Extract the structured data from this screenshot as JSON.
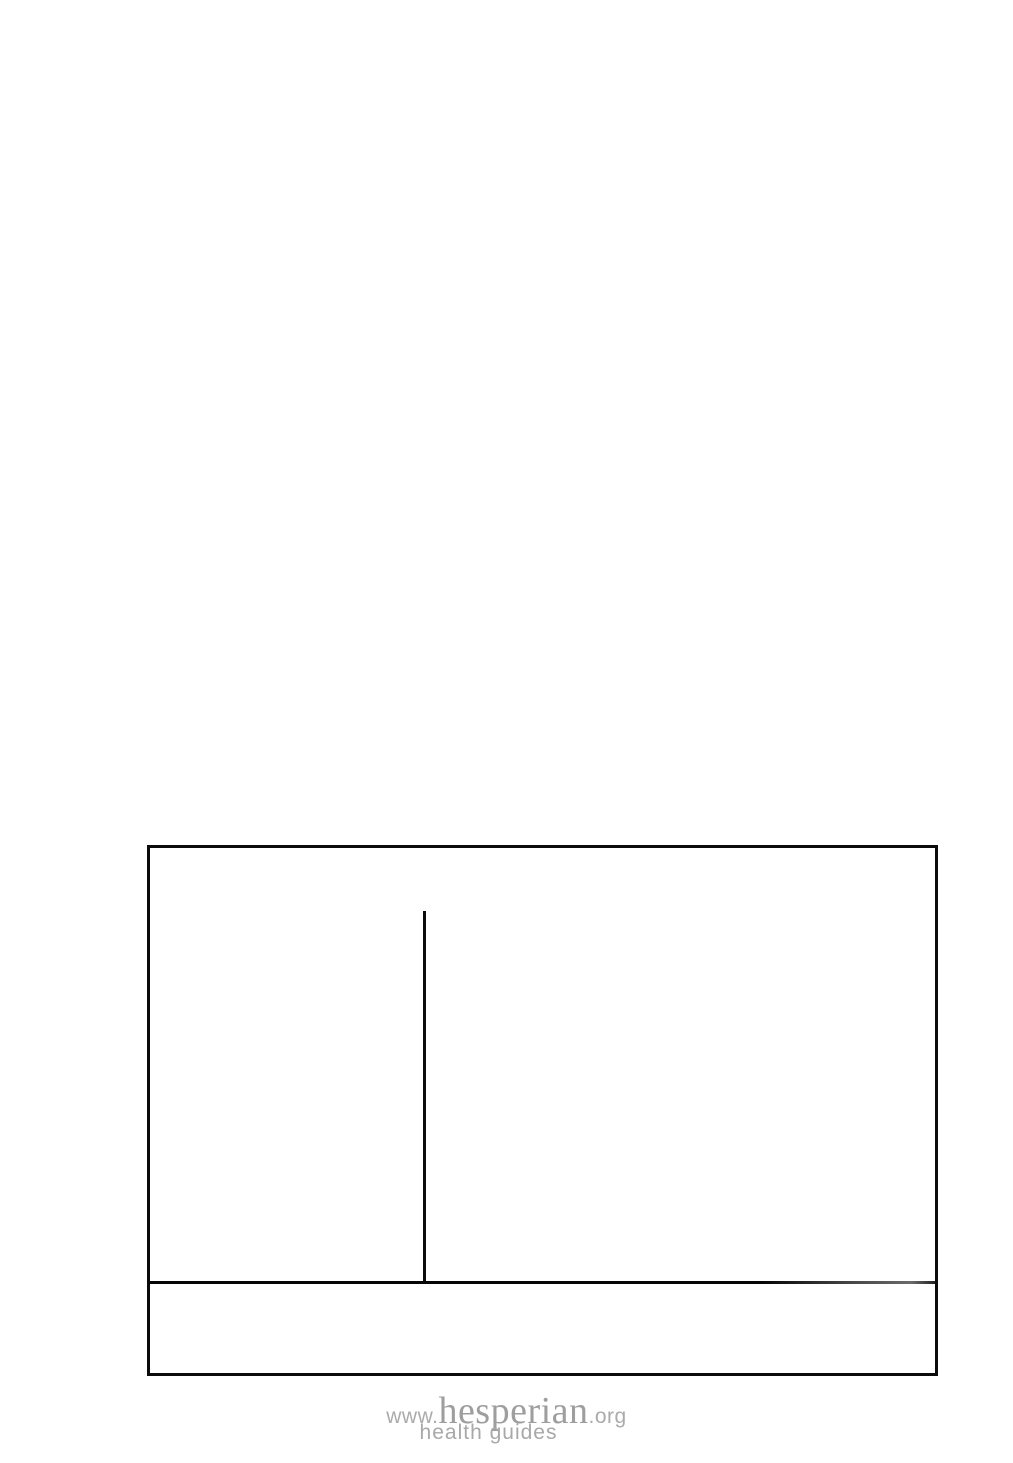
{
  "page": {
    "background_color": "#ffffff",
    "line_color": "#0b0b0b"
  },
  "story_box": {
    "border_color": "#0b0b0b",
    "content": ""
  },
  "footer_logo": {
    "prefix": "www.",
    "brand": "hesperian",
    "suffix": ".org",
    "tagline": "health guides",
    "text_color": "#a5a5a5"
  }
}
